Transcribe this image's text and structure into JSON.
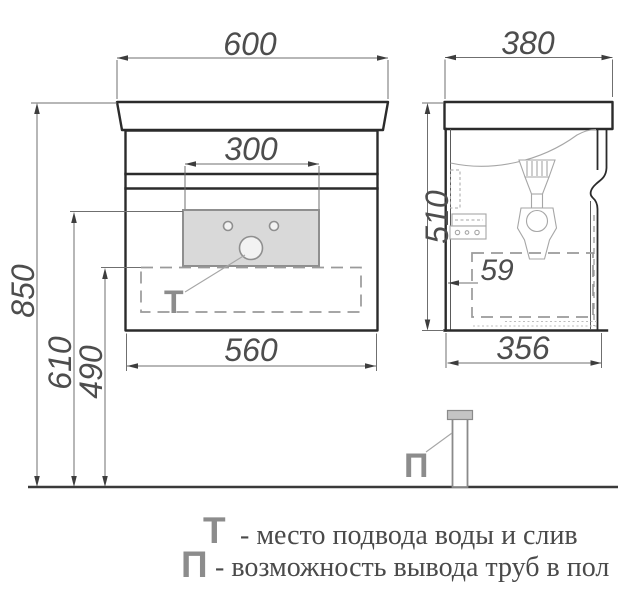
{
  "dimensions": {
    "front_width_top": "600",
    "front_faucet_zone": "300",
    "front_width_bottom": "560",
    "height_total": "850",
    "height_supply": "610",
    "height_drain_zone": "490",
    "side_depth_top": "380",
    "side_height": "510",
    "side_back_offset": "59",
    "side_depth_bottom": "356"
  },
  "symbols": {
    "water": "Т",
    "pipes": "П"
  },
  "legend": {
    "items": [
      {
        "symbol": "Т",
        "text": "- место подвода воды и слив"
      },
      {
        "symbol": "П",
        "text": "- возможность вывода труб в пол"
      }
    ]
  },
  "colors": {
    "outline_dark": "#2b2b2b",
    "dim_line": "#6f6f6f",
    "dim_text": "#4d4d4d",
    "arrow": "#3d3d3d",
    "detail_line": "#a6a6a6",
    "dash_line": "#9a9a9a",
    "panel_fill": "#d9d9d9",
    "panel_stroke": "#8f8f8f",
    "symbol_gray": "#8c8c8c",
    "legend_text": "#4a4a4a",
    "floor": "#3a3a3a",
    "pipe_fill": "#c4c4c4"
  }
}
